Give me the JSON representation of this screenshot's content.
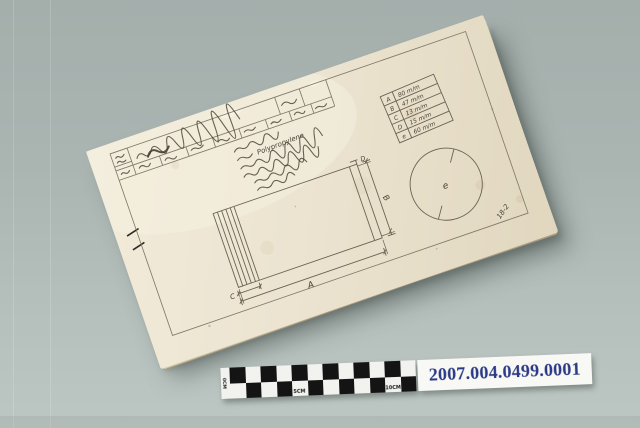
{
  "scene": {
    "background_color": "#aab4b1"
  },
  "booklet": {
    "page_color": "#ece4d1",
    "handwritten_page_number": "18-2",
    "material_note": "Polypropylene",
    "dimension_table": {
      "rows": [
        {
          "label": "A",
          "value": "80 m/m"
        },
        {
          "label": "B",
          "value": "47 m/m"
        },
        {
          "label": "C",
          "value": "13 m/m"
        },
        {
          "label": "D",
          "value": "15 m/m"
        },
        {
          "label": "e",
          "value": "60 m/m"
        }
      ]
    }
  },
  "scale_bar": {
    "cols": 12,
    "rows": 2,
    "labels": [
      "0CM",
      "5CM",
      "10CM"
    ]
  },
  "accession_label": {
    "number": "2007.004.0499.0001",
    "text_color": "#2b3a85"
  }
}
